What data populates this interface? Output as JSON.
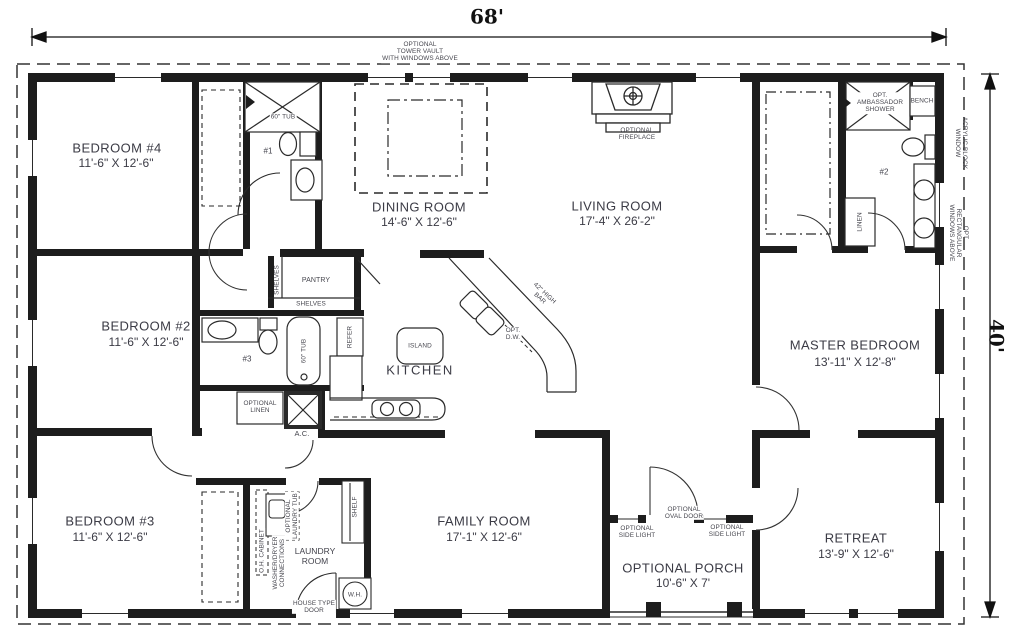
{
  "plan": {
    "dim_width": "68'",
    "dim_height": "40'",
    "rooms": {
      "bedroom4": {
        "name": "BEDROOM #4",
        "dims": "11'-6\" X 12'-6\""
      },
      "bedroom2": {
        "name": "BEDROOM #2",
        "dims": "11'-6\" X 12'-6\""
      },
      "bedroom3": {
        "name": "BEDROOM #3",
        "dims": "11'-6\" X 12'-6\""
      },
      "dining": {
        "name": "DINING ROOM",
        "dims": "14'-6\" X 12'-6\""
      },
      "living": {
        "name": "LIVING ROOM",
        "dims": "17'-4\" X 26'-2\""
      },
      "kitchen": {
        "name": "KITCHEN"
      },
      "family": {
        "name": "FAMILY ROOM",
        "dims": "17'-1\" X 12'-6\""
      },
      "master": {
        "name": "MASTER BEDROOM",
        "dims": "13'-11\" X 12'-8\""
      },
      "retreat": {
        "name": "RETREAT",
        "dims": "13'-9\" X 12'-6\""
      },
      "porch": {
        "name": "OPTIONAL PORCH",
        "dims": "10'-6\" X 7'"
      },
      "laundry": {
        "name": "LAUNDRY\nROOM"
      }
    },
    "notes": {
      "tower_vault": "OPTIONAL\nTOWER VAULT\nWITH WINDOWS ABOVE",
      "fireplace": "OPTIONAL\nFIREPLACE",
      "tub_bath1": "60\" TUB",
      "tub_bath3": "60\" TUB",
      "num1": "#1",
      "num2": "#2",
      "num3": "#3",
      "shower": "OPT.\nAMBASSADOR\nSHOWER",
      "bench": "BENCH",
      "acrylic_window": "ACRYLIC BLOCK\nWINDOW",
      "opt_rect_windows": "OPT. RECTANGULAR\nWINDOWS ABOVE",
      "linen": "LINEN",
      "shelves_left": "SHELVES",
      "shelves_bottom": "SHELVES",
      "pantry": "PANTRY",
      "refer": "REFER",
      "island": "ISLAND",
      "high_bar": "42\" HIGH\nBAR",
      "opt_dw": "OPT.\nD.W.",
      "opt_linen": "OPTIONAL\nLINEN",
      "ac": "A.C.",
      "oh_cabinet": "O.H. CABINET",
      "washer_dryer": "WASHER/DRYER\nCONNECTIONS",
      "laundry_tub": "OPTIONAL\nLAUNDRY TUB",
      "house_door": "HOUSE TYPE\nDOOR",
      "wh": "W.H.",
      "shelf": "SHELF",
      "oval_door": "OPTIONAL\nOVAL DOOR",
      "side_light": "OPTIONAL\nSIDE LIGHT"
    },
    "colors": {
      "wall": "#1d1d1d",
      "label": "#3b3b45",
      "line": "#2a2a2a"
    }
  }
}
